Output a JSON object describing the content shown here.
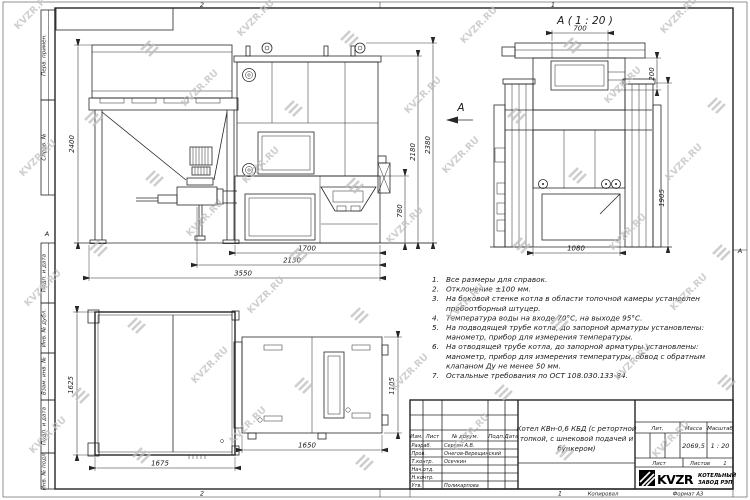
{
  "watermark": {
    "text": "KVZR.RU"
  },
  "frame": {
    "left_labels": [
      "Перв. примен.",
      "Справ. №",
      "Подп. и дата",
      "Инв. № дубл.",
      "Взам. инв. №",
      "Подп. и дата",
      "Инв. № подл."
    ],
    "zones": {
      "top_left": "2",
      "top_right": "1",
      "bottom_left": "2",
      "bottom_right": "1",
      "left": "А",
      "right": "А"
    }
  },
  "views": {
    "detail": {
      "title": "А ( 1 : 20 )",
      "dim_top": "700",
      "dim_right_small": "200",
      "dim_right": "1905",
      "dim_bottom": "1080"
    },
    "side": {
      "dim_left": "2400",
      "dim_outer": "2380",
      "dim_inner": "2180",
      "dim_lower": "780",
      "dim_b1": "1700",
      "dim_b2": "2130",
      "dim_b3": "3550",
      "view_arrow": "А"
    },
    "plan": {
      "dim_left": "1625",
      "dim_bottom_left": "1675",
      "dim_bottom_right": "1650",
      "dim_right": "1105"
    }
  },
  "notes": [
    {
      "num": "1.",
      "lines": [
        "Все размеры для справок."
      ]
    },
    {
      "num": "2.",
      "lines": [
        "Отклонение ±100 мм."
      ]
    },
    {
      "num": "3.",
      "lines": [
        "На боковой стенке котла в области топочной камеры установлен",
        "пробоотборный штуцер."
      ]
    },
    {
      "num": "4.",
      "lines": [
        "Температура воды на входе 70°С, на выходе 95°С."
      ]
    },
    {
      "num": "5.",
      "lines": [
        "На подводящей трубе котла, до запорной арматуры установлены:",
        "манометр, прибор для измерения температуры."
      ]
    },
    {
      "num": "6.",
      "lines": [
        "На отводящей трубе котла, до запорной арматуры установлены:",
        "манометр, прибор для измерения температуры, обвод с обратным",
        "клапаном Ду не менее 50 мм."
      ]
    },
    {
      "num": "7.",
      "lines": [
        "Остальные требования по ОСТ 108.030.133-84."
      ]
    }
  ],
  "title_block": {
    "header_cols": [
      "Изм.",
      "Лист",
      "№ докум.",
      "Подп.",
      "Дата"
    ],
    "sign_rows": [
      {
        "role": "Разраб.",
        "name": "Сергин А.В."
      },
      {
        "role": "Пров.",
        "name": "Онегов-Верещинский"
      },
      {
        "role": "Т.контр.",
        "name": "Осечкин"
      },
      {
        "role": "Нач.отд.",
        "name": ""
      },
      {
        "role": "Н.контр.",
        "name": ""
      },
      {
        "role": "Утв.",
        "name": "Поликарпова"
      }
    ],
    "doc_title_lines": [
      "Котел КВн-0,6 КБД (с ретортной",
      "топкой, с шнековой подачей и",
      "бункером)"
    ],
    "lit_label": "Лит.",
    "mass_label": "Масса",
    "mass_value": "2069,5",
    "scale_label": "Масштаб",
    "scale_value": "1 : 20",
    "sheet_label": "Лист",
    "sheets_label": "Листов",
    "sheets_value": "1",
    "logo_text": "KVZR",
    "company_line1": "КОТЕЛЬНЫЙ",
    "company_line2": "ЗАВОД РЭП"
  },
  "footer": {
    "copied_label": "Копировал",
    "format_label": "Формат А3"
  }
}
